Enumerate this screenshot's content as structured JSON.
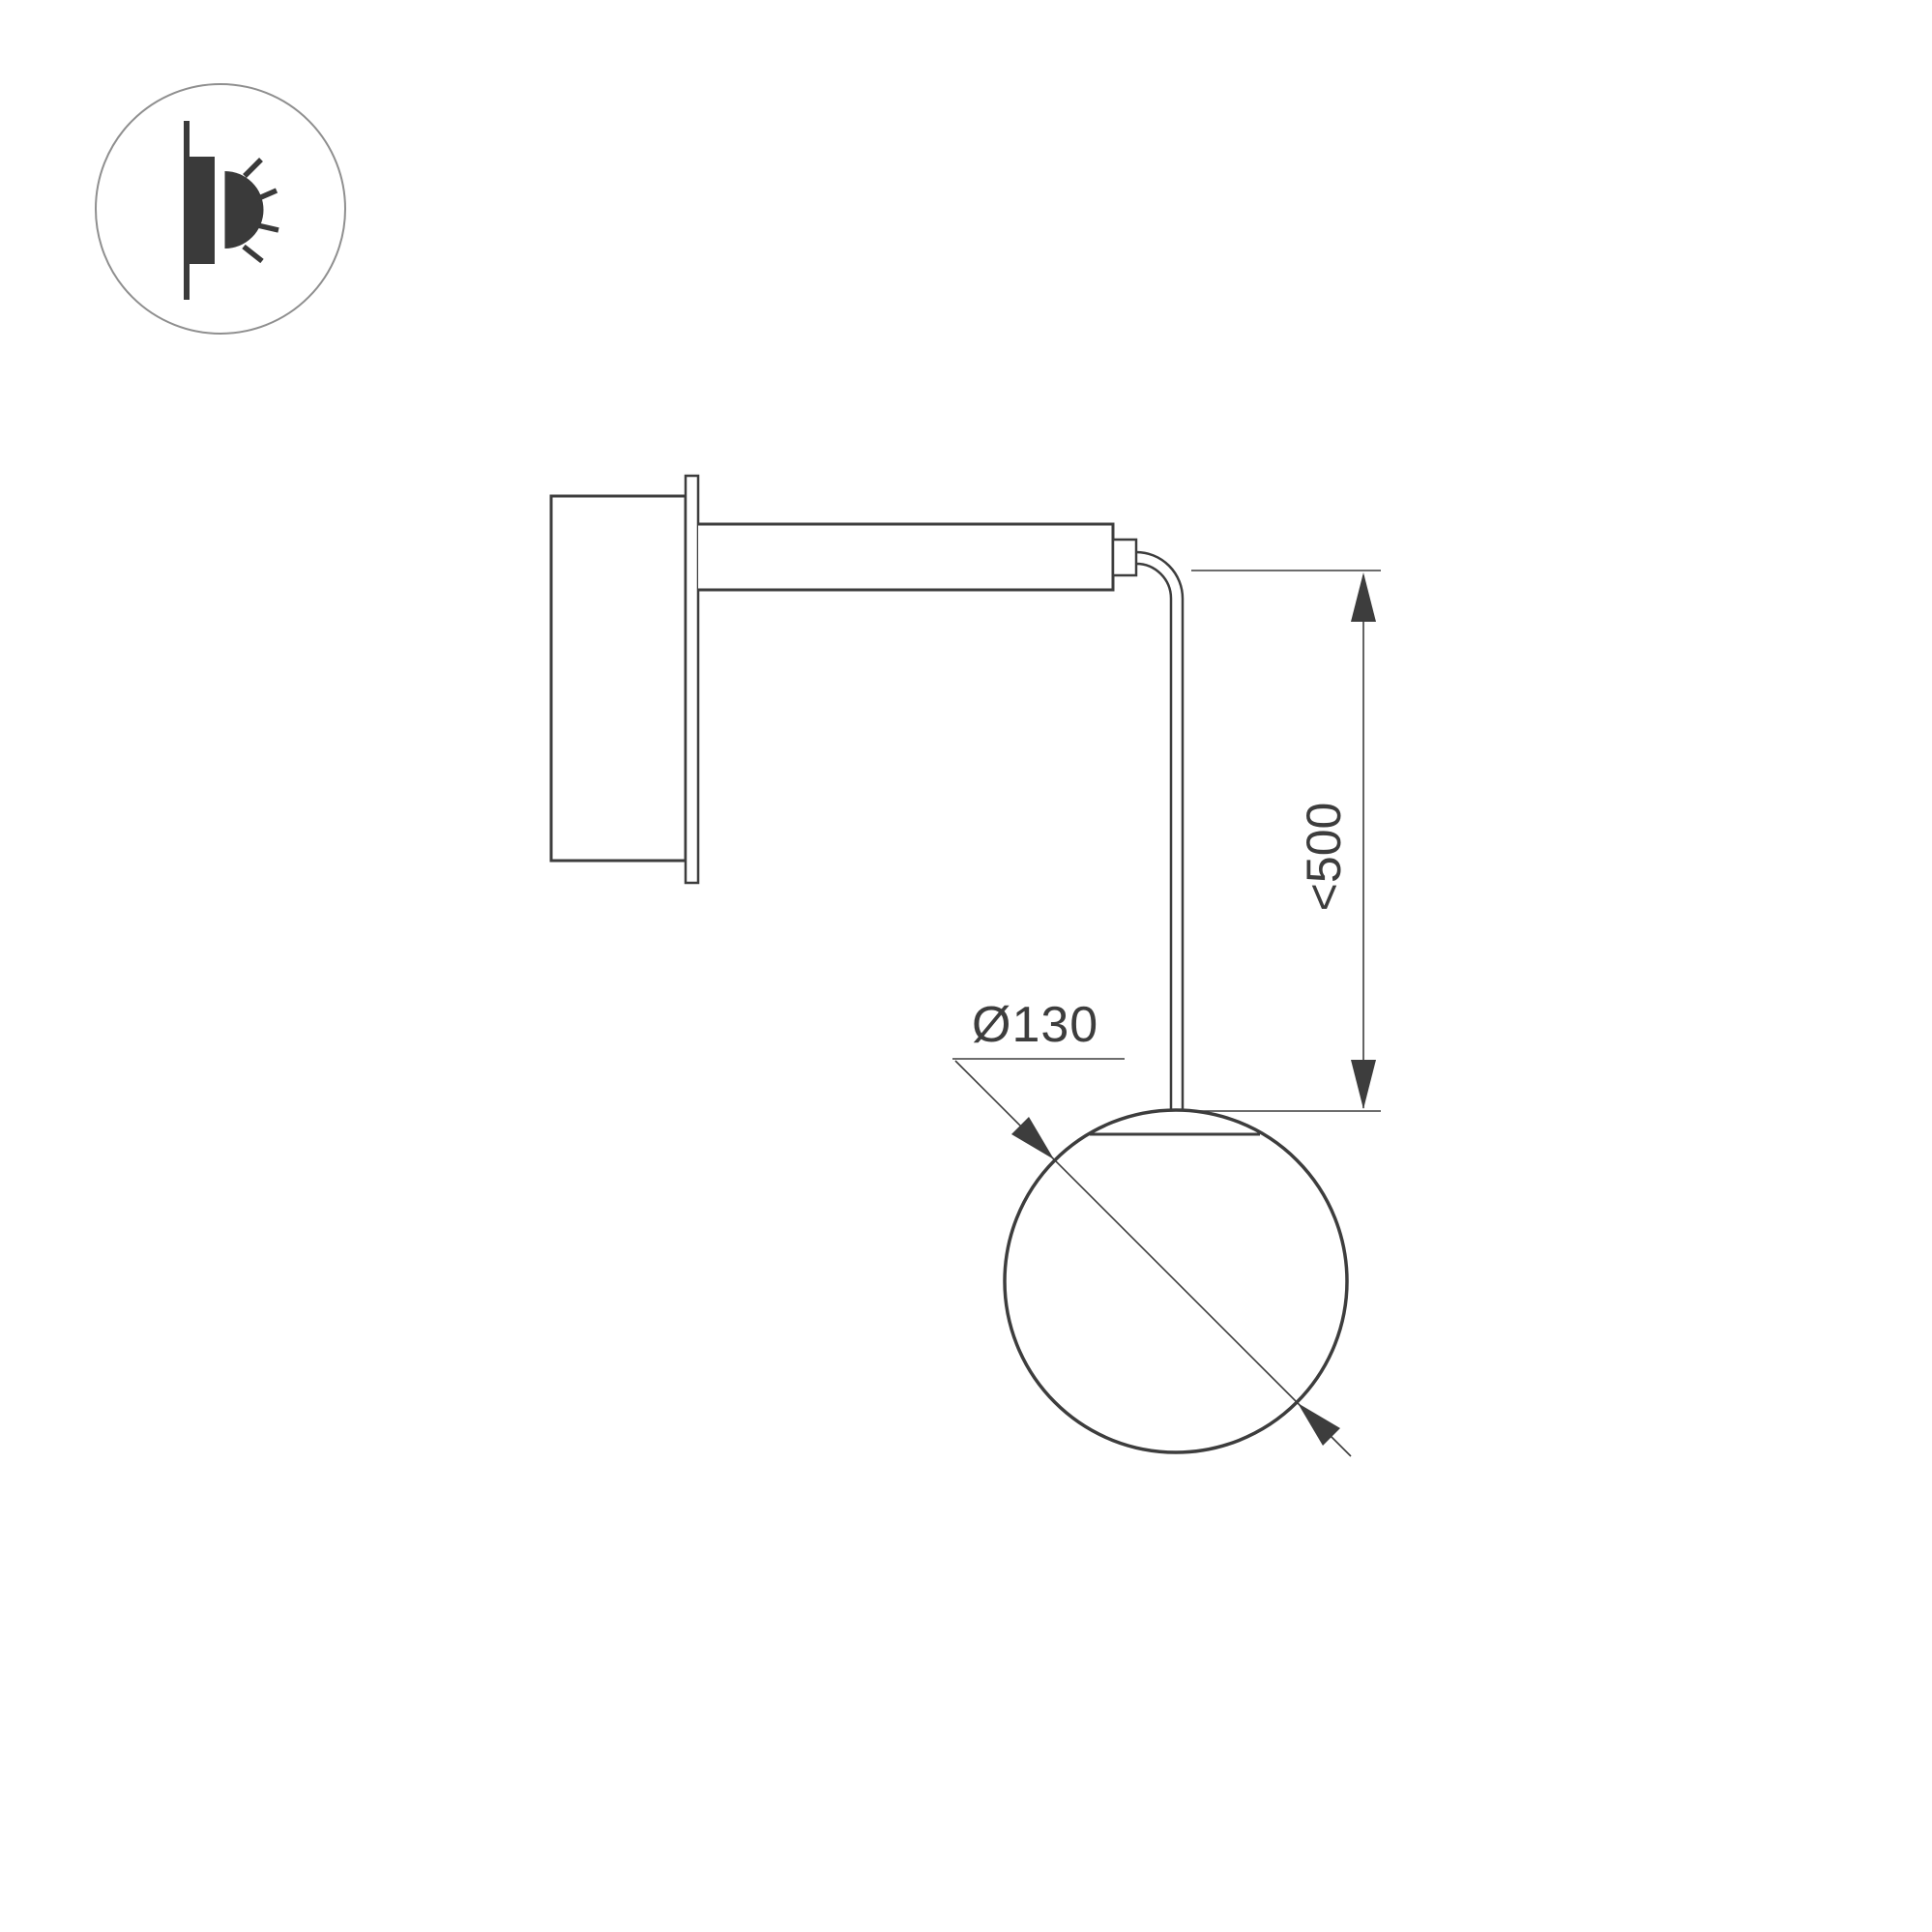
{
  "colors": {
    "bg": "#ffffff",
    "line": "#3d3d3d",
    "icon-fill": "#3a3a3a",
    "icon-ring": "#8f8f8f"
  },
  "legend_icon": {
    "name": "wall-light-icon"
  },
  "dimensions": {
    "suspension_height": {
      "label": "<500"
    },
    "globe_diameter": {
      "label": "Ø130"
    }
  }
}
